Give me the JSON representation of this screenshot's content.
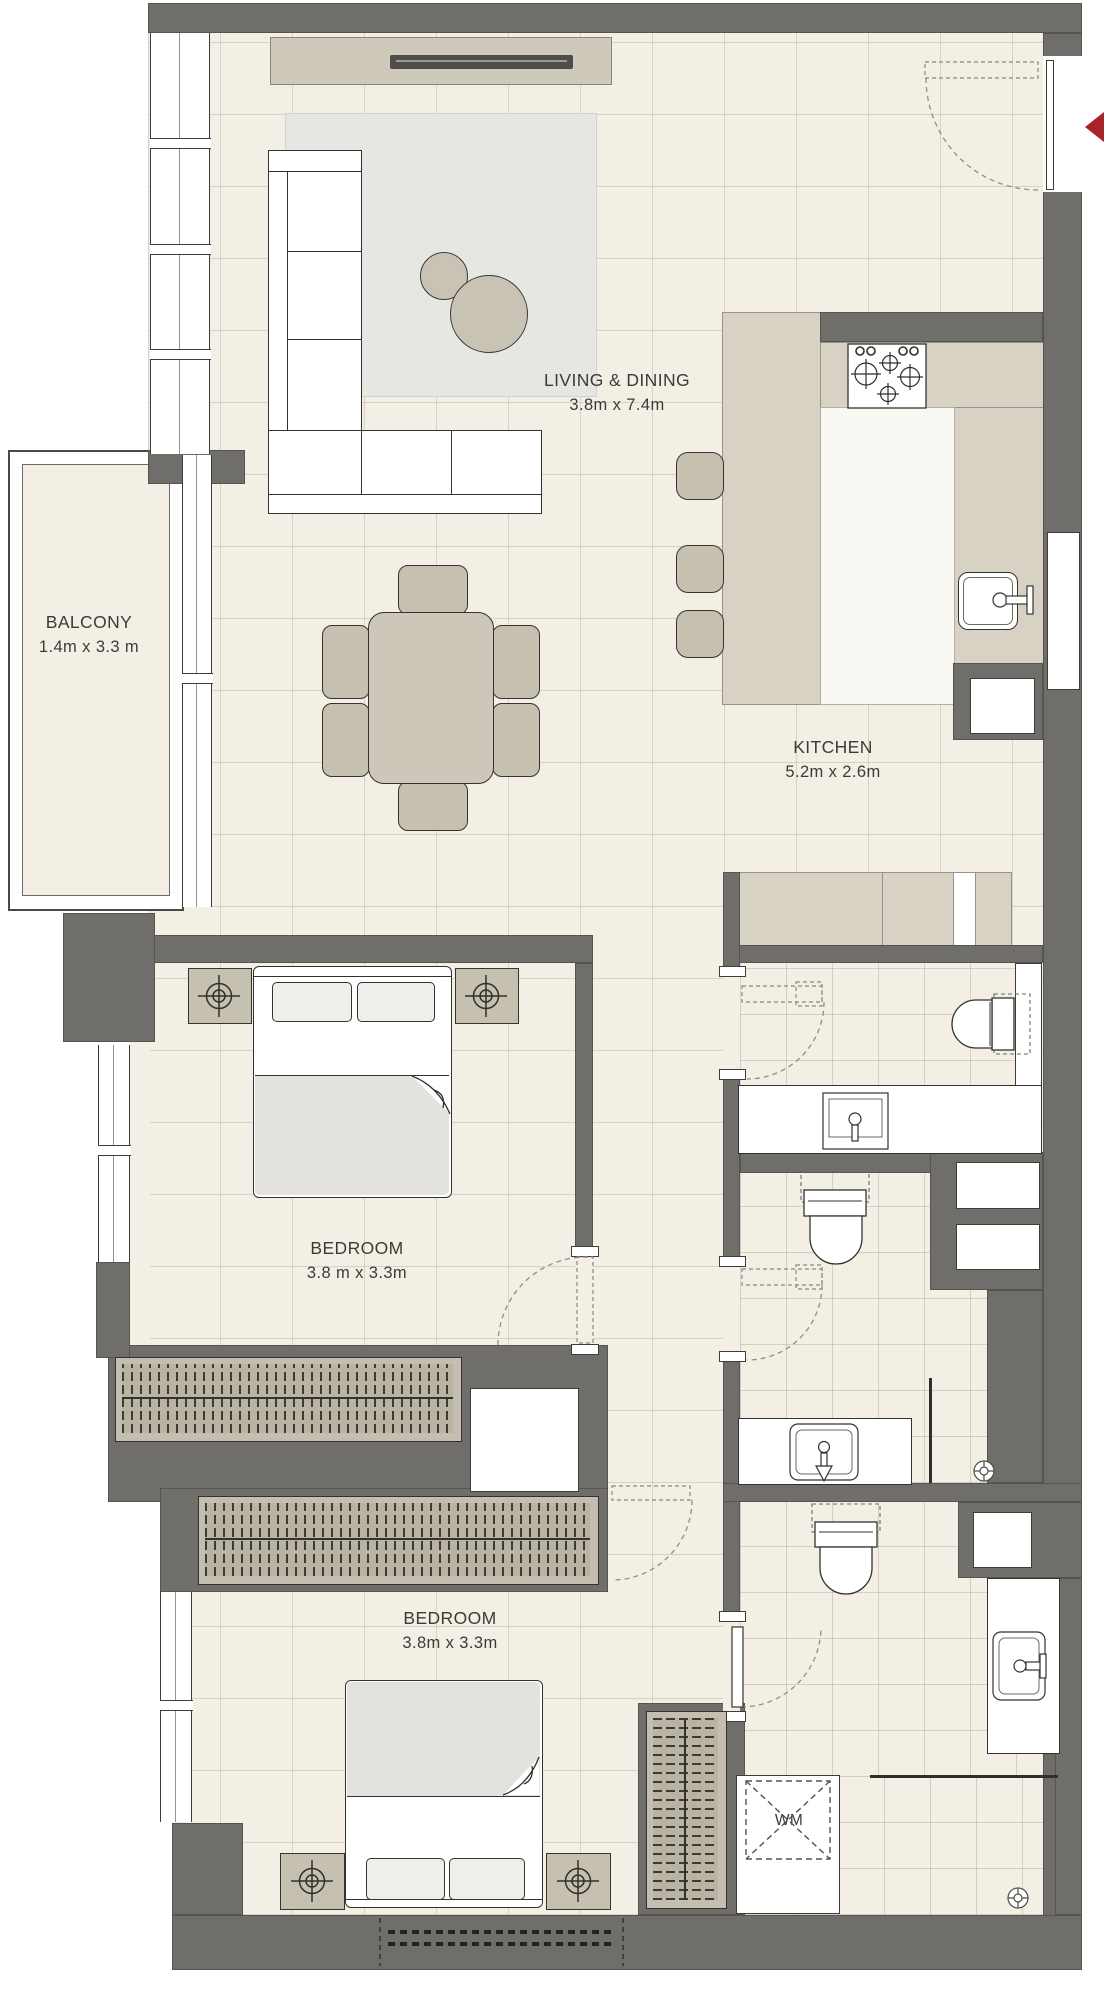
{
  "rooms": {
    "living_dining": {
      "name": "LIVING & DINING",
      "dims": "3.8m x 7.4m"
    },
    "balcony": {
      "name": "BALCONY",
      "dims": "1.4m x 3.3 m"
    },
    "kitchen": {
      "name": "KITCHEN",
      "dims": "5.2m x 2.6m"
    },
    "bedroom_1": {
      "name": "BEDROOM",
      "dims": "3.8 m x 3.3m"
    },
    "bedroom_2": {
      "name": "BEDROOM",
      "dims": "3.8m x 3.3m"
    }
  },
  "appliances": {
    "washing_machine": "WM"
  },
  "colors": {
    "wall": "#6f6e6b",
    "floor": "#f3efe5",
    "counter": "#d8d2c4",
    "rug": "#e6e6e2",
    "entrance_arrow": "#a8232a",
    "fixture_outline": "#33322e"
  }
}
